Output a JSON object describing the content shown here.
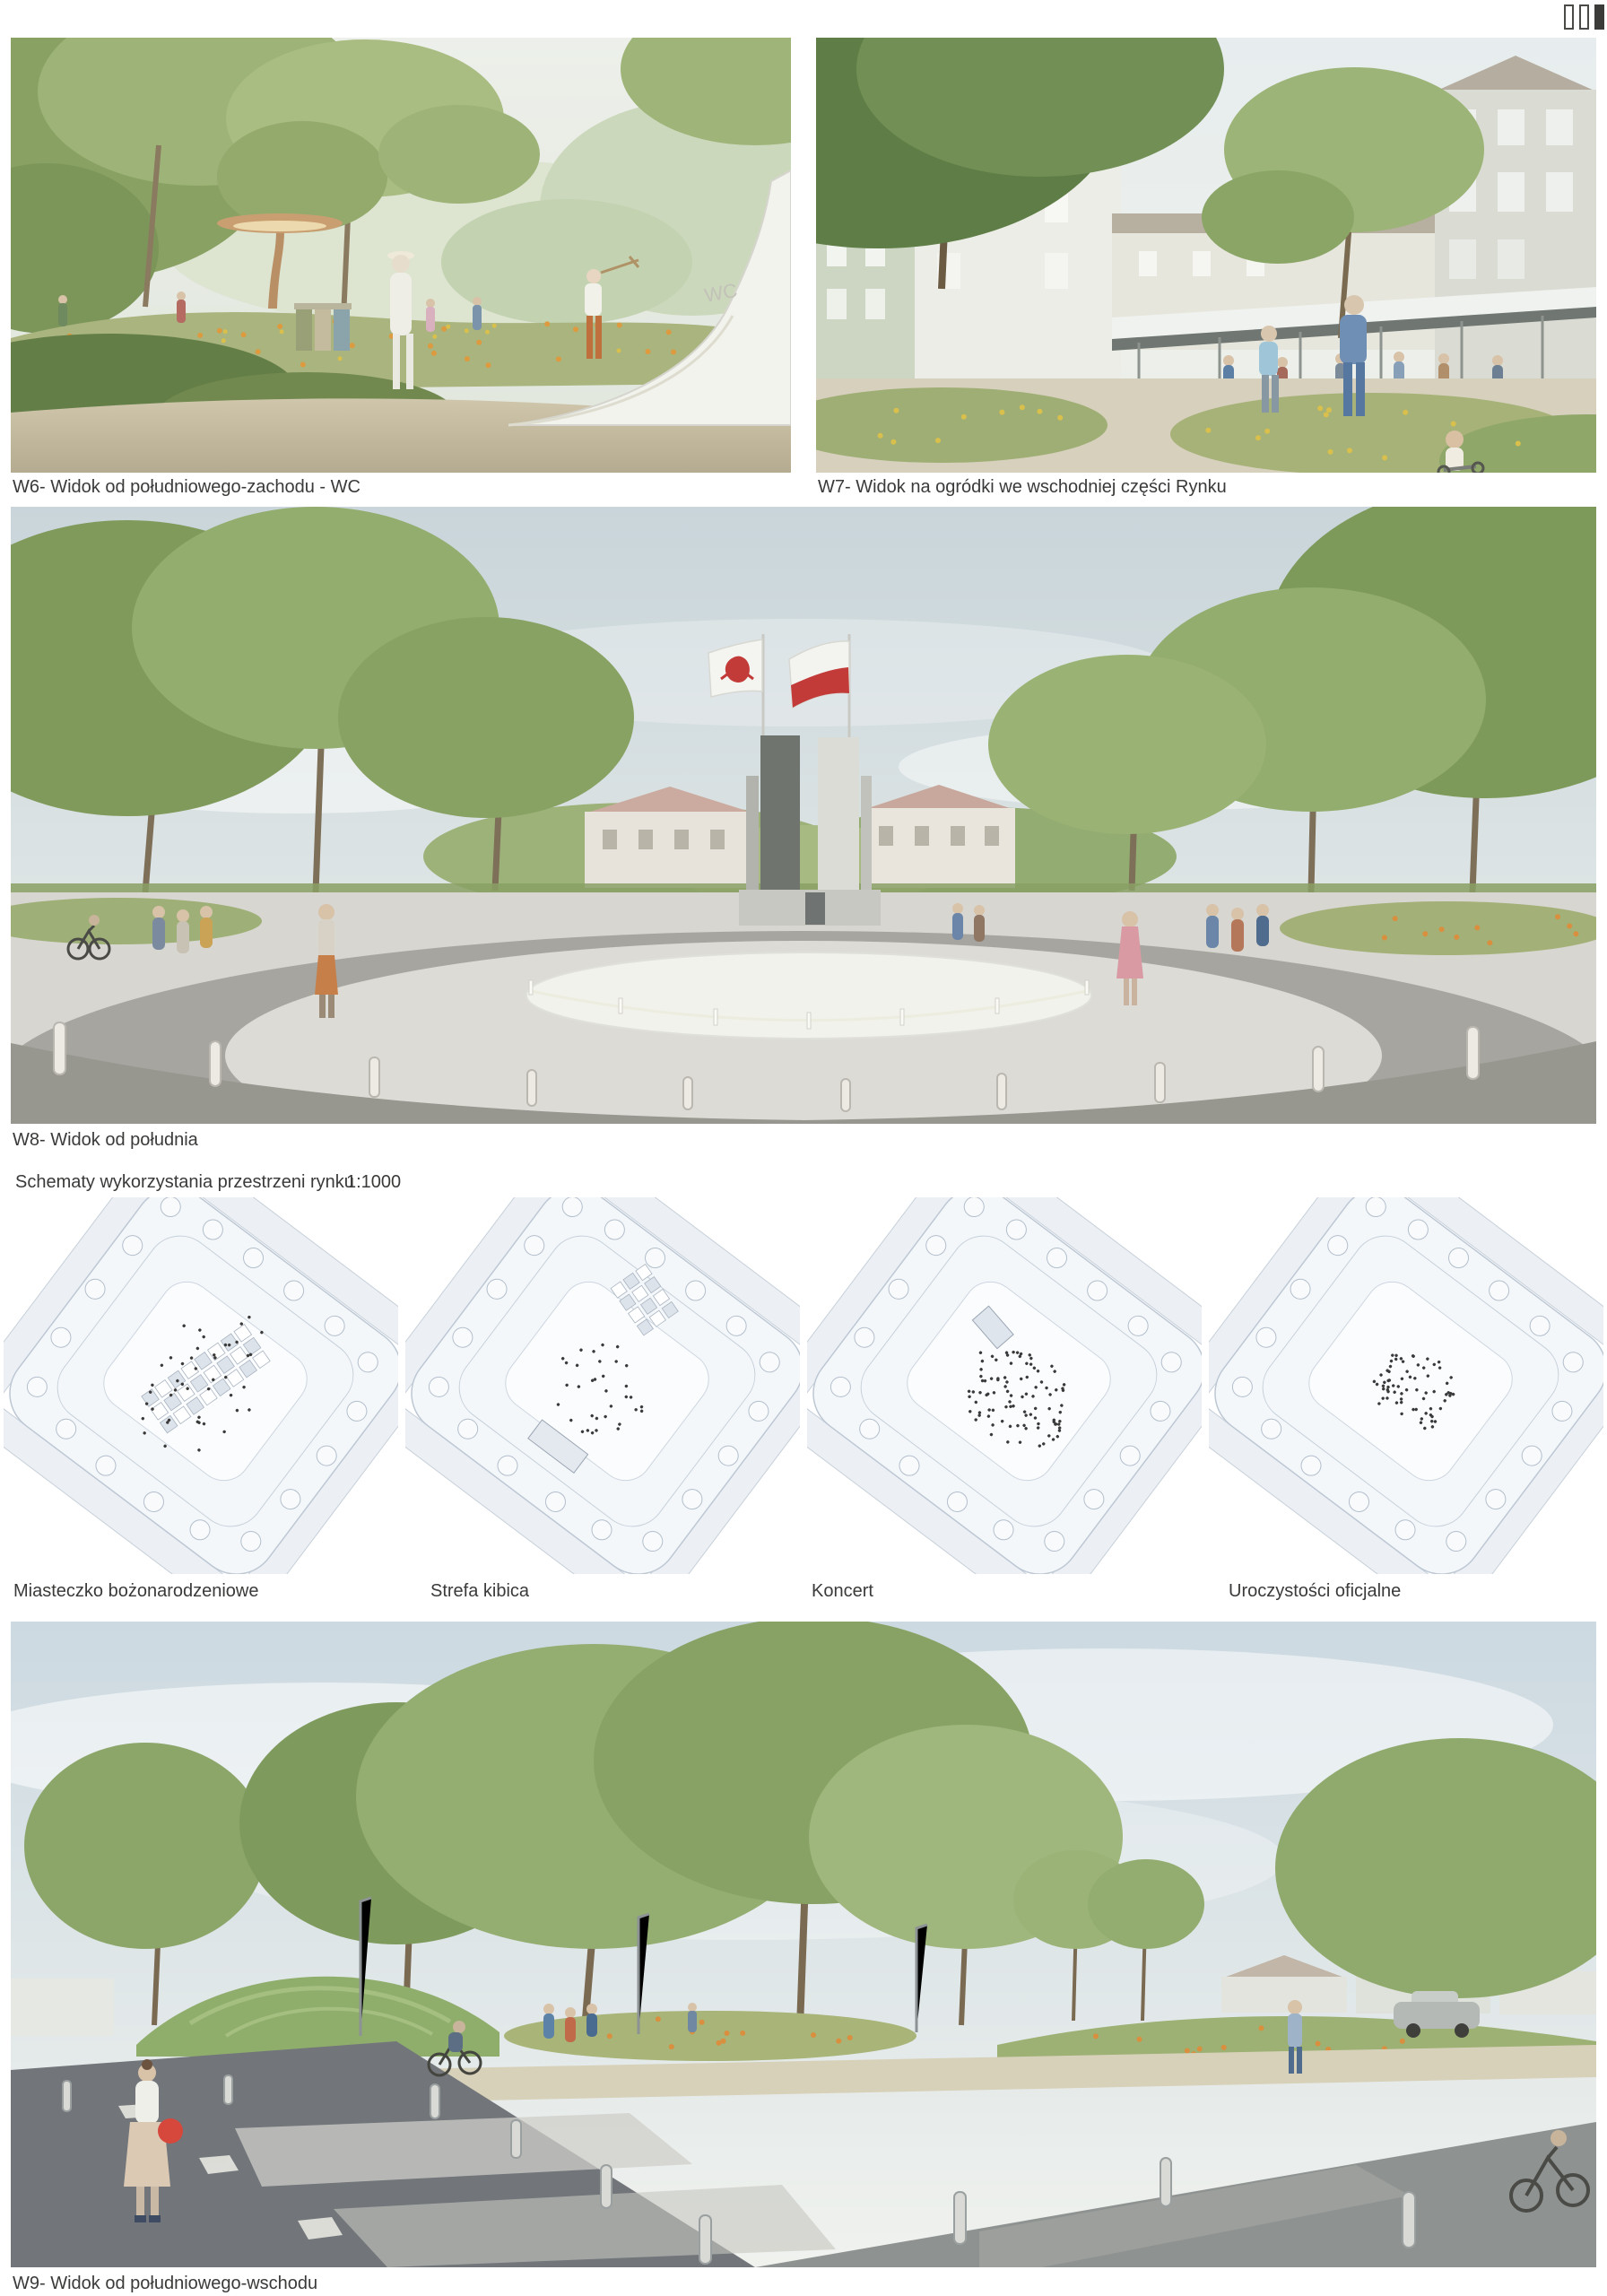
{
  "page_indicator": {
    "total": 3,
    "active": 3
  },
  "views": {
    "w6": {
      "caption": "W6- Widok od południowego-zachodu - WC",
      "wall_text": "WC"
    },
    "w7": {
      "caption": "W7- Widok na ogródki we wschodniej części Rynku"
    },
    "w8": {
      "caption": "W8- Widok od południa"
    },
    "w9": {
      "caption": "W9- Widok od południowego-wschodu"
    }
  },
  "schemes": {
    "title": "Schematy wykorzystania przestrzeni rynku",
    "scale": "1:1000",
    "items": [
      {
        "label": "Miasteczko bożonarodzeniowe"
      },
      {
        "label": "Strefa kibica"
      },
      {
        "label": "Koncert"
      },
      {
        "label": "Uroczystości oficjalne"
      }
    ]
  },
  "colors": {
    "caption_text": "#3a3a38",
    "flag_red": "#c23b39",
    "diagram_line": "#bdc8d4",
    "foliage_green": "#8fa868",
    "asphalt": "#72767a"
  }
}
